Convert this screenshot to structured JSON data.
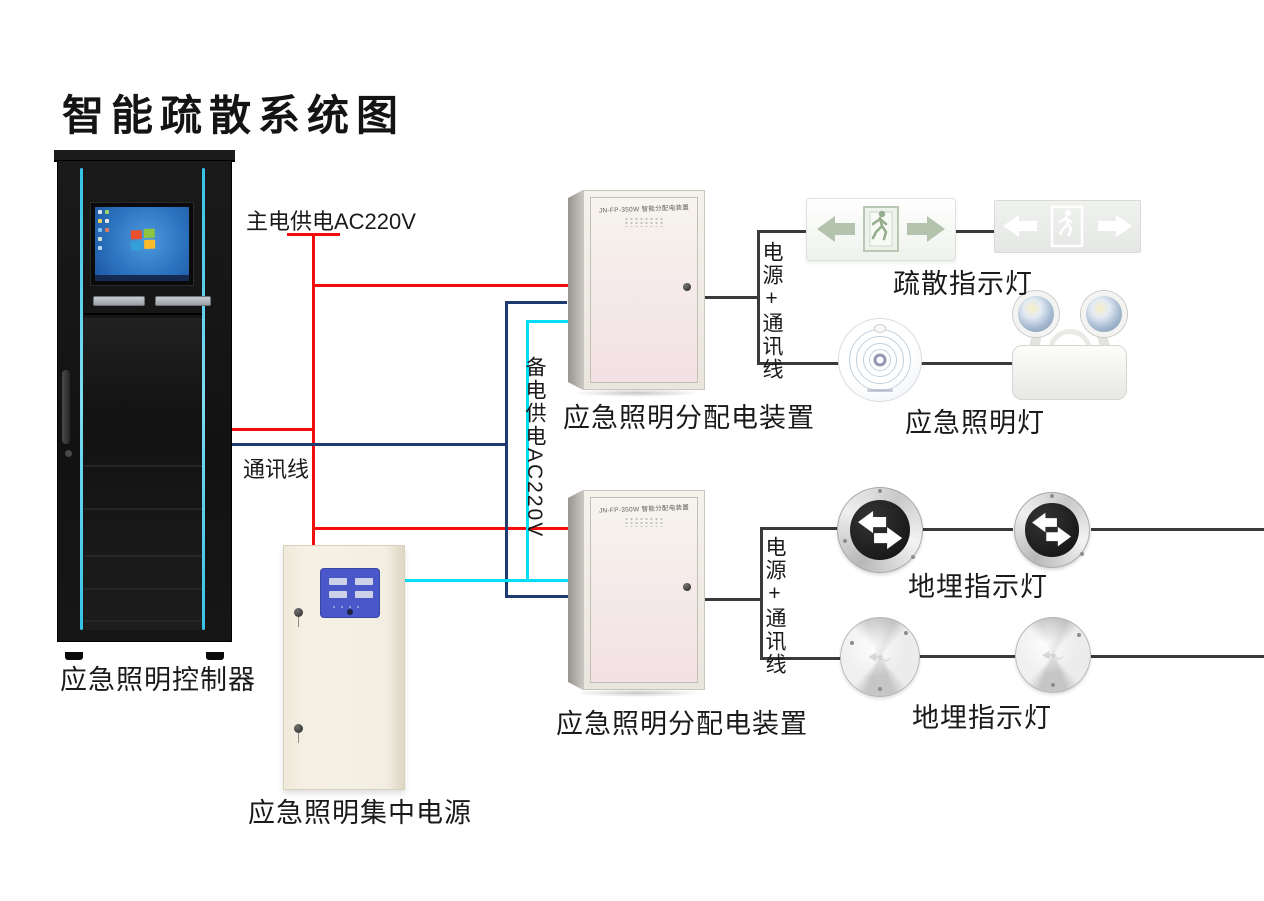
{
  "title": "智能疏散系统图",
  "colors": {
    "main_power_red": "#f50c0c",
    "comm_navy": "#1e3a6e",
    "backup_cyan": "#00dff5",
    "connector_gray": "#3a3a3a",
    "cabinet_accent_cyan": "#35c3e8"
  },
  "wiring": {
    "main_power_label": "主电供电AC220V",
    "comm_label": "通讯线",
    "backup_label": "备电供电AC220V"
  },
  "controller": {
    "label": "应急照明控制器"
  },
  "central_power": {
    "label": "应急照明集中电源"
  },
  "distribution_boxes": [
    {
      "model": "JN-FP-350W 智能分配电装置",
      "label": "应急照明分配电装置",
      "bus_label": "电源+通讯线"
    },
    {
      "model": "JN-FP-350W 智能分配电装置",
      "label": "应急照明分配电装置",
      "bus_label": "电源+通讯线"
    }
  ],
  "devices": {
    "exit_signs_label": "疏散指示灯",
    "emergency_lamps_label": "应急照明灯",
    "ground_row1_label": "地埋指示灯",
    "ground_row2_label": "地埋指示灯"
  }
}
